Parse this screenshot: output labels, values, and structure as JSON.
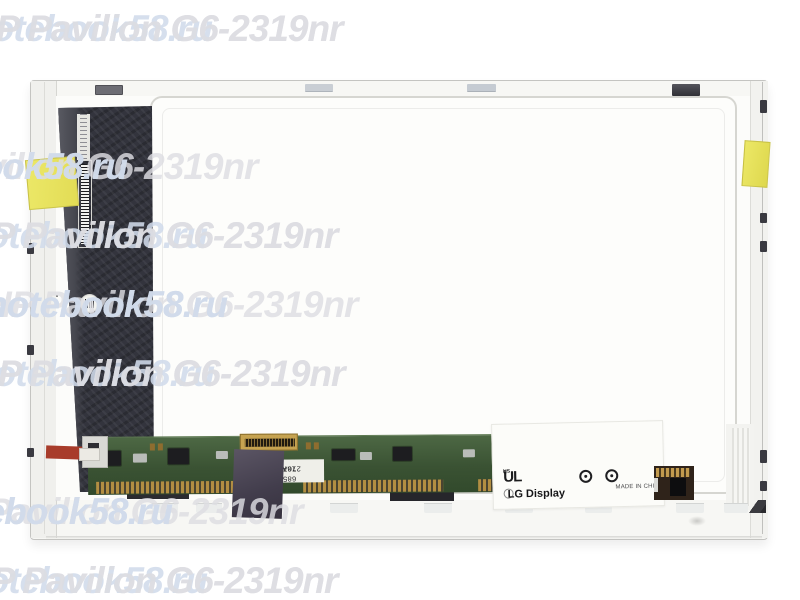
{
  "watermark": {
    "site_text": "notebook58.ru",
    "model_text": "HP Pavilion G6-2319nr",
    "site_color": "rgba(208,219,235,0.88)",
    "model_color": "rgba(221,221,226,0.82)",
    "gap": 58,
    "rows": [
      {
        "top": 8,
        "left": -30,
        "parts": [
          "model",
          "site",
          "model"
        ]
      },
      {
        "top": 77,
        "left": -545,
        "parts": [
          "site",
          "model",
          "site",
          "model"
        ]
      },
      {
        "top": 146,
        "left": -115,
        "parts": [
          "site",
          "model",
          "site"
        ]
      },
      {
        "top": 215,
        "left": -35,
        "parts": [
          "model",
          "site",
          "model"
        ]
      },
      {
        "top": 284,
        "left": -15,
        "parts": [
          "site",
          "model",
          "site"
        ]
      },
      {
        "top": 353,
        "left": -28,
        "parts": [
          "model",
          "site",
          "model"
        ]
      },
      {
        "top": 422,
        "left": -395,
        "parts": [
          "model",
          "site",
          "model"
        ]
      },
      {
        "top": 491,
        "left": -70,
        "parts": [
          "site",
          "model",
          "site"
        ]
      },
      {
        "top": 560,
        "left": -35,
        "parts": [
          "model",
          "site",
          "model"
        ]
      }
    ]
  },
  "photo": {
    "pcb_label": {
      "line1": "685 16A",
      "line2": "2707616"
    },
    "big_label": {
      "ul_prefix": "c",
      "ul_core": "UL",
      "ul_suffix": "US",
      "lg_text": "LG Display",
      "made_in": "MADE IN CHINA"
    },
    "colors": {
      "tape_yellow": "#ece868",
      "pcb_green": "#4d6844",
      "gold": "#c6a351",
      "slab_dark": "#33343d"
    }
  }
}
